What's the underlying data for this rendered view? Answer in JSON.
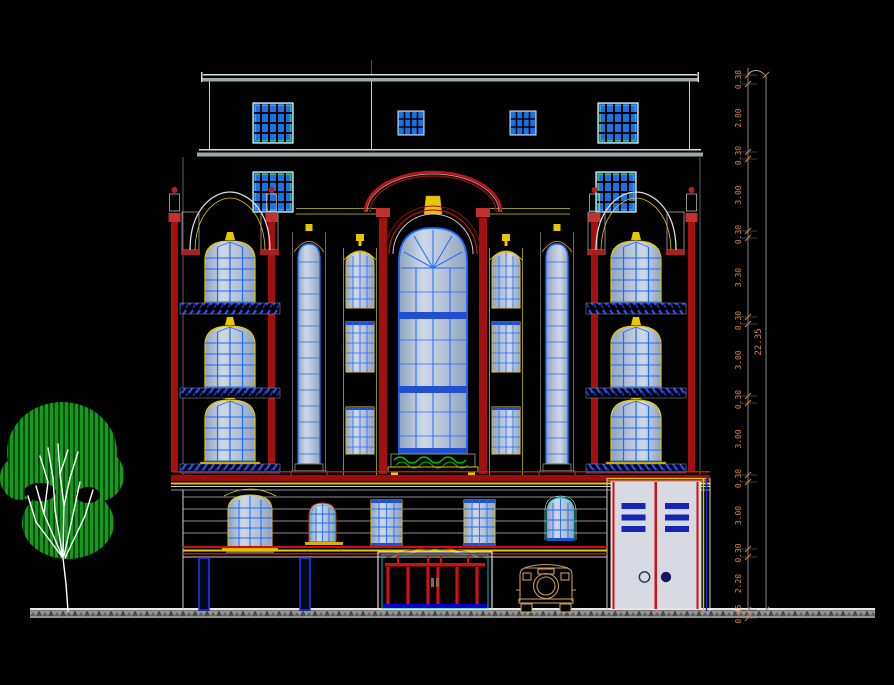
{
  "dimensions": {
    "segments": [
      "0.38",
      "2.80",
      "0.30",
      "3.00",
      "0.30",
      "3.30",
      "0.30",
      "3.00",
      "0.30",
      "3.00",
      "0.30",
      "3.00",
      "0.30",
      "2.20",
      "0.45"
    ],
    "total": "22.35"
  },
  "colors": {
    "background": "#000000",
    "window_frame_blue": "#1e6bff",
    "glass_gray": "#b8c2d4",
    "accent_red": "#cc1111",
    "trim_yellow": "#e6c800",
    "cornice_white": "#dddddd",
    "tree_green": "#169a1e",
    "planter_green": "#00cc00",
    "door_panel_gray": "#d7dae3",
    "door_bar_blue": "#1326b8",
    "car_tan": "#c79a5b",
    "dimension_text_orange": "#d4874a",
    "earth_hatch_gray": "#969696"
  }
}
